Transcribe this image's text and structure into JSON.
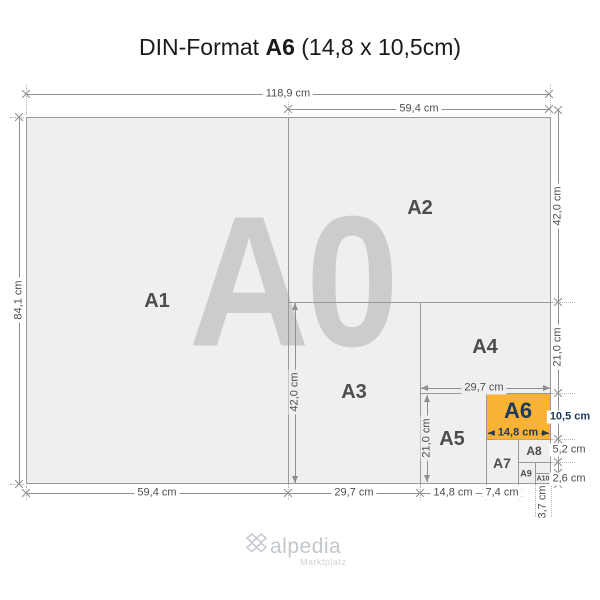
{
  "title": {
    "prefix": "DIN-Format ",
    "emphasis": "A6",
    "suffix": " (14,8 x 10,5cm)"
  },
  "watermark": "A0",
  "papers": {
    "a1": "A1",
    "a2": "A2",
    "a3": "A3",
    "a4": "A4",
    "a5": "A5",
    "a6": "A6",
    "a7": "A7",
    "a8": "A8",
    "a9": "A9",
    "a10": "A10"
  },
  "dims": {
    "top_total": "118,9 cm",
    "top_half": "59,4 cm",
    "left_total": "84,1 cm",
    "right_a2": "42,0 cm",
    "right_a4": "21,0 cm",
    "right_a6": "10,5 cm",
    "right_a8": "5,2 cm",
    "right_a10": "2,6 cm",
    "bottom_a1": "59,4 cm",
    "bottom_a3": "29,7 cm",
    "bottom_a5": "14,8 cm",
    "bottom_a7": "7,4 cm",
    "bottom_a9": "3,7 cm",
    "inner_a3_height": "42,0 cm",
    "inner_a5_height": "21,0 cm",
    "inner_a4_width": "29,7 cm",
    "inner_a6_width": "14,8 cm"
  },
  "colors": {
    "highlight": "#F9B233",
    "navy": "#1D3A5C"
  },
  "logo": {
    "name": "alpedia",
    "tagline": "Marktplatz"
  }
}
